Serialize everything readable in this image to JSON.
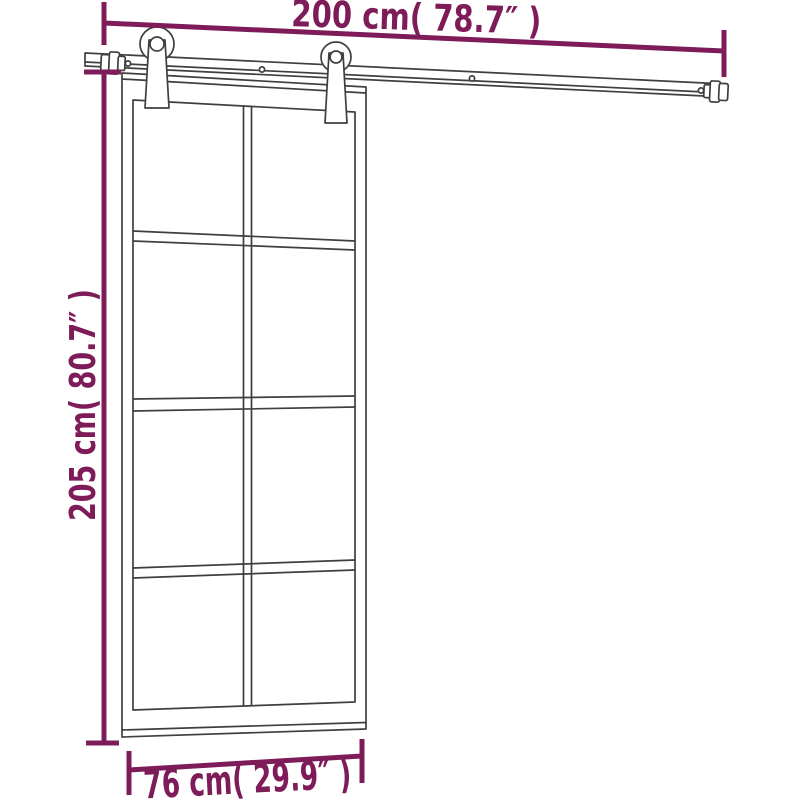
{
  "diagram": {
    "type": "product-dimension-drawing",
    "subject": "sliding glass door with hardware track kit",
    "colors": {
      "accent": "#7d1c58",
      "ink": "#3f3f3f",
      "background": "#ffffff"
    },
    "dimensions": {
      "track_width": {
        "label": "200 cm( 78.7″ )",
        "cm": 200,
        "inches": 78.7,
        "position": "top"
      },
      "door_height": {
        "label": "205 cm( 80.7″ )",
        "cm": 205,
        "inches": 80.7,
        "position": "left"
      },
      "door_width": {
        "label": "76 cm( 29.9″ )",
        "cm": 76,
        "inches": 29.9,
        "position": "bottom"
      }
    },
    "door": {
      "glass_columns": 2,
      "glass_rows": 4,
      "glass_panels": 8
    },
    "hardware": {
      "rollers": 2,
      "end_stops": 2,
      "rail_screw_holes": 4
    }
  }
}
